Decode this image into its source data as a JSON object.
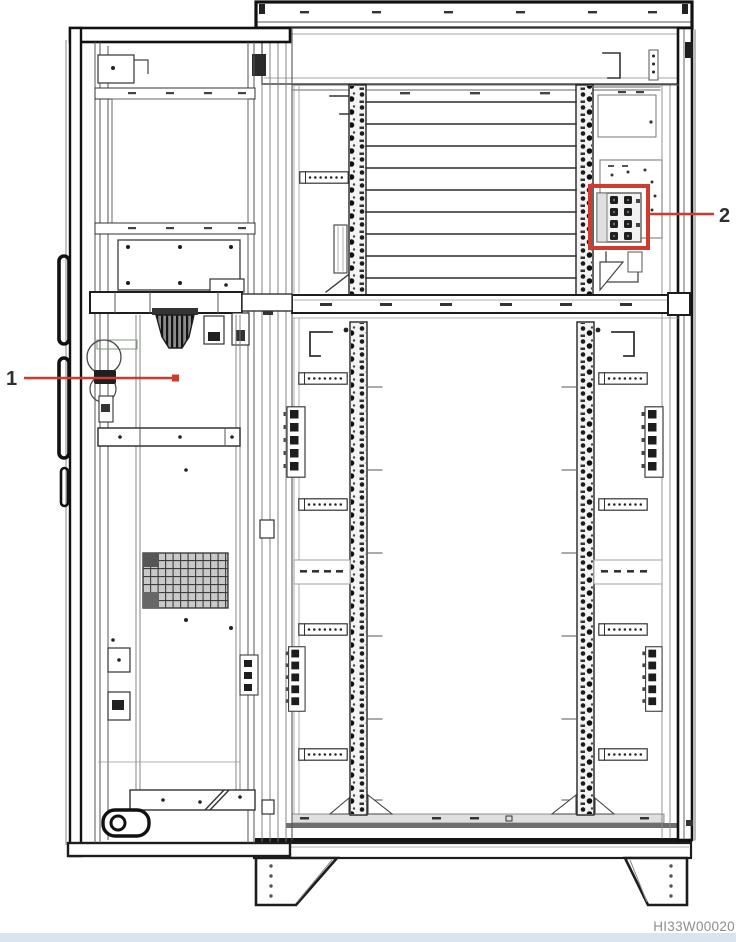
{
  "diagram": {
    "callouts": [
      {
        "label": "1"
      },
      {
        "label": "2"
      }
    ],
    "figure_code": "HI33W00020"
  },
  "colors": {
    "callout_red": "#cf3b2e",
    "label_text": "#2f2f2f",
    "line_heavy": "#161616",
    "line_medium": "#3c3c3c",
    "line_light": "#8a8a8a",
    "figure_code_gray": "#8e8e8e",
    "footer_strip_blue": "#dae4ee",
    "background": "#ffffff"
  }
}
